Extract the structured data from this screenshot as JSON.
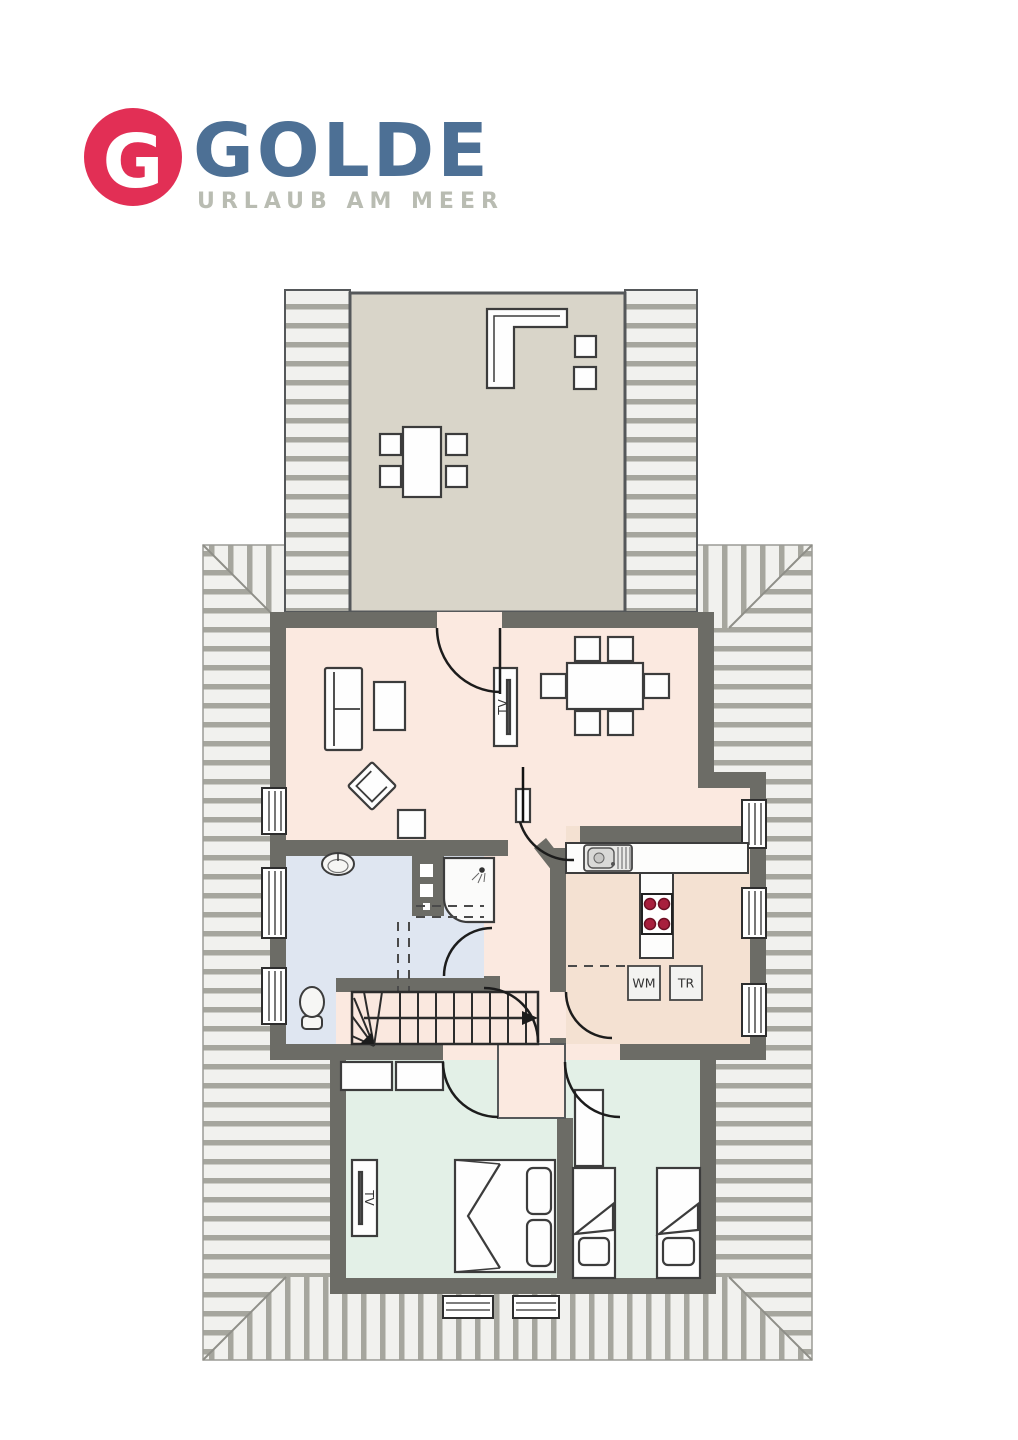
{
  "logo": {
    "monogram": "G",
    "brand": "GOLDE",
    "tagline": "URLAUB AM MEER",
    "colors": {
      "mark": "#e22f55",
      "monogram": "#ffffff",
      "brand": "#4d7095",
      "tagline": "#b9bcb2"
    }
  },
  "floorplan": {
    "labels": {
      "living_tv": "TV",
      "bedroom_tv": "TV",
      "washing_machine": "WM",
      "dryer": "TR"
    },
    "colors": {
      "wall": "#6c6c66",
      "floor_living": "#fbe9e0",
      "floor_kitchen": "#f4e1d2",
      "floor_bath": "#dfe6f1",
      "floor_bedroom": "#e3f0e7",
      "floor_balcony": "#d9d5c9",
      "hatch_line": "#a6a69e",
      "hatch_bg": "#f1f1ee",
      "burner_red": "#a81f3d",
      "furniture_outline": "#3c3c3c"
    }
  }
}
